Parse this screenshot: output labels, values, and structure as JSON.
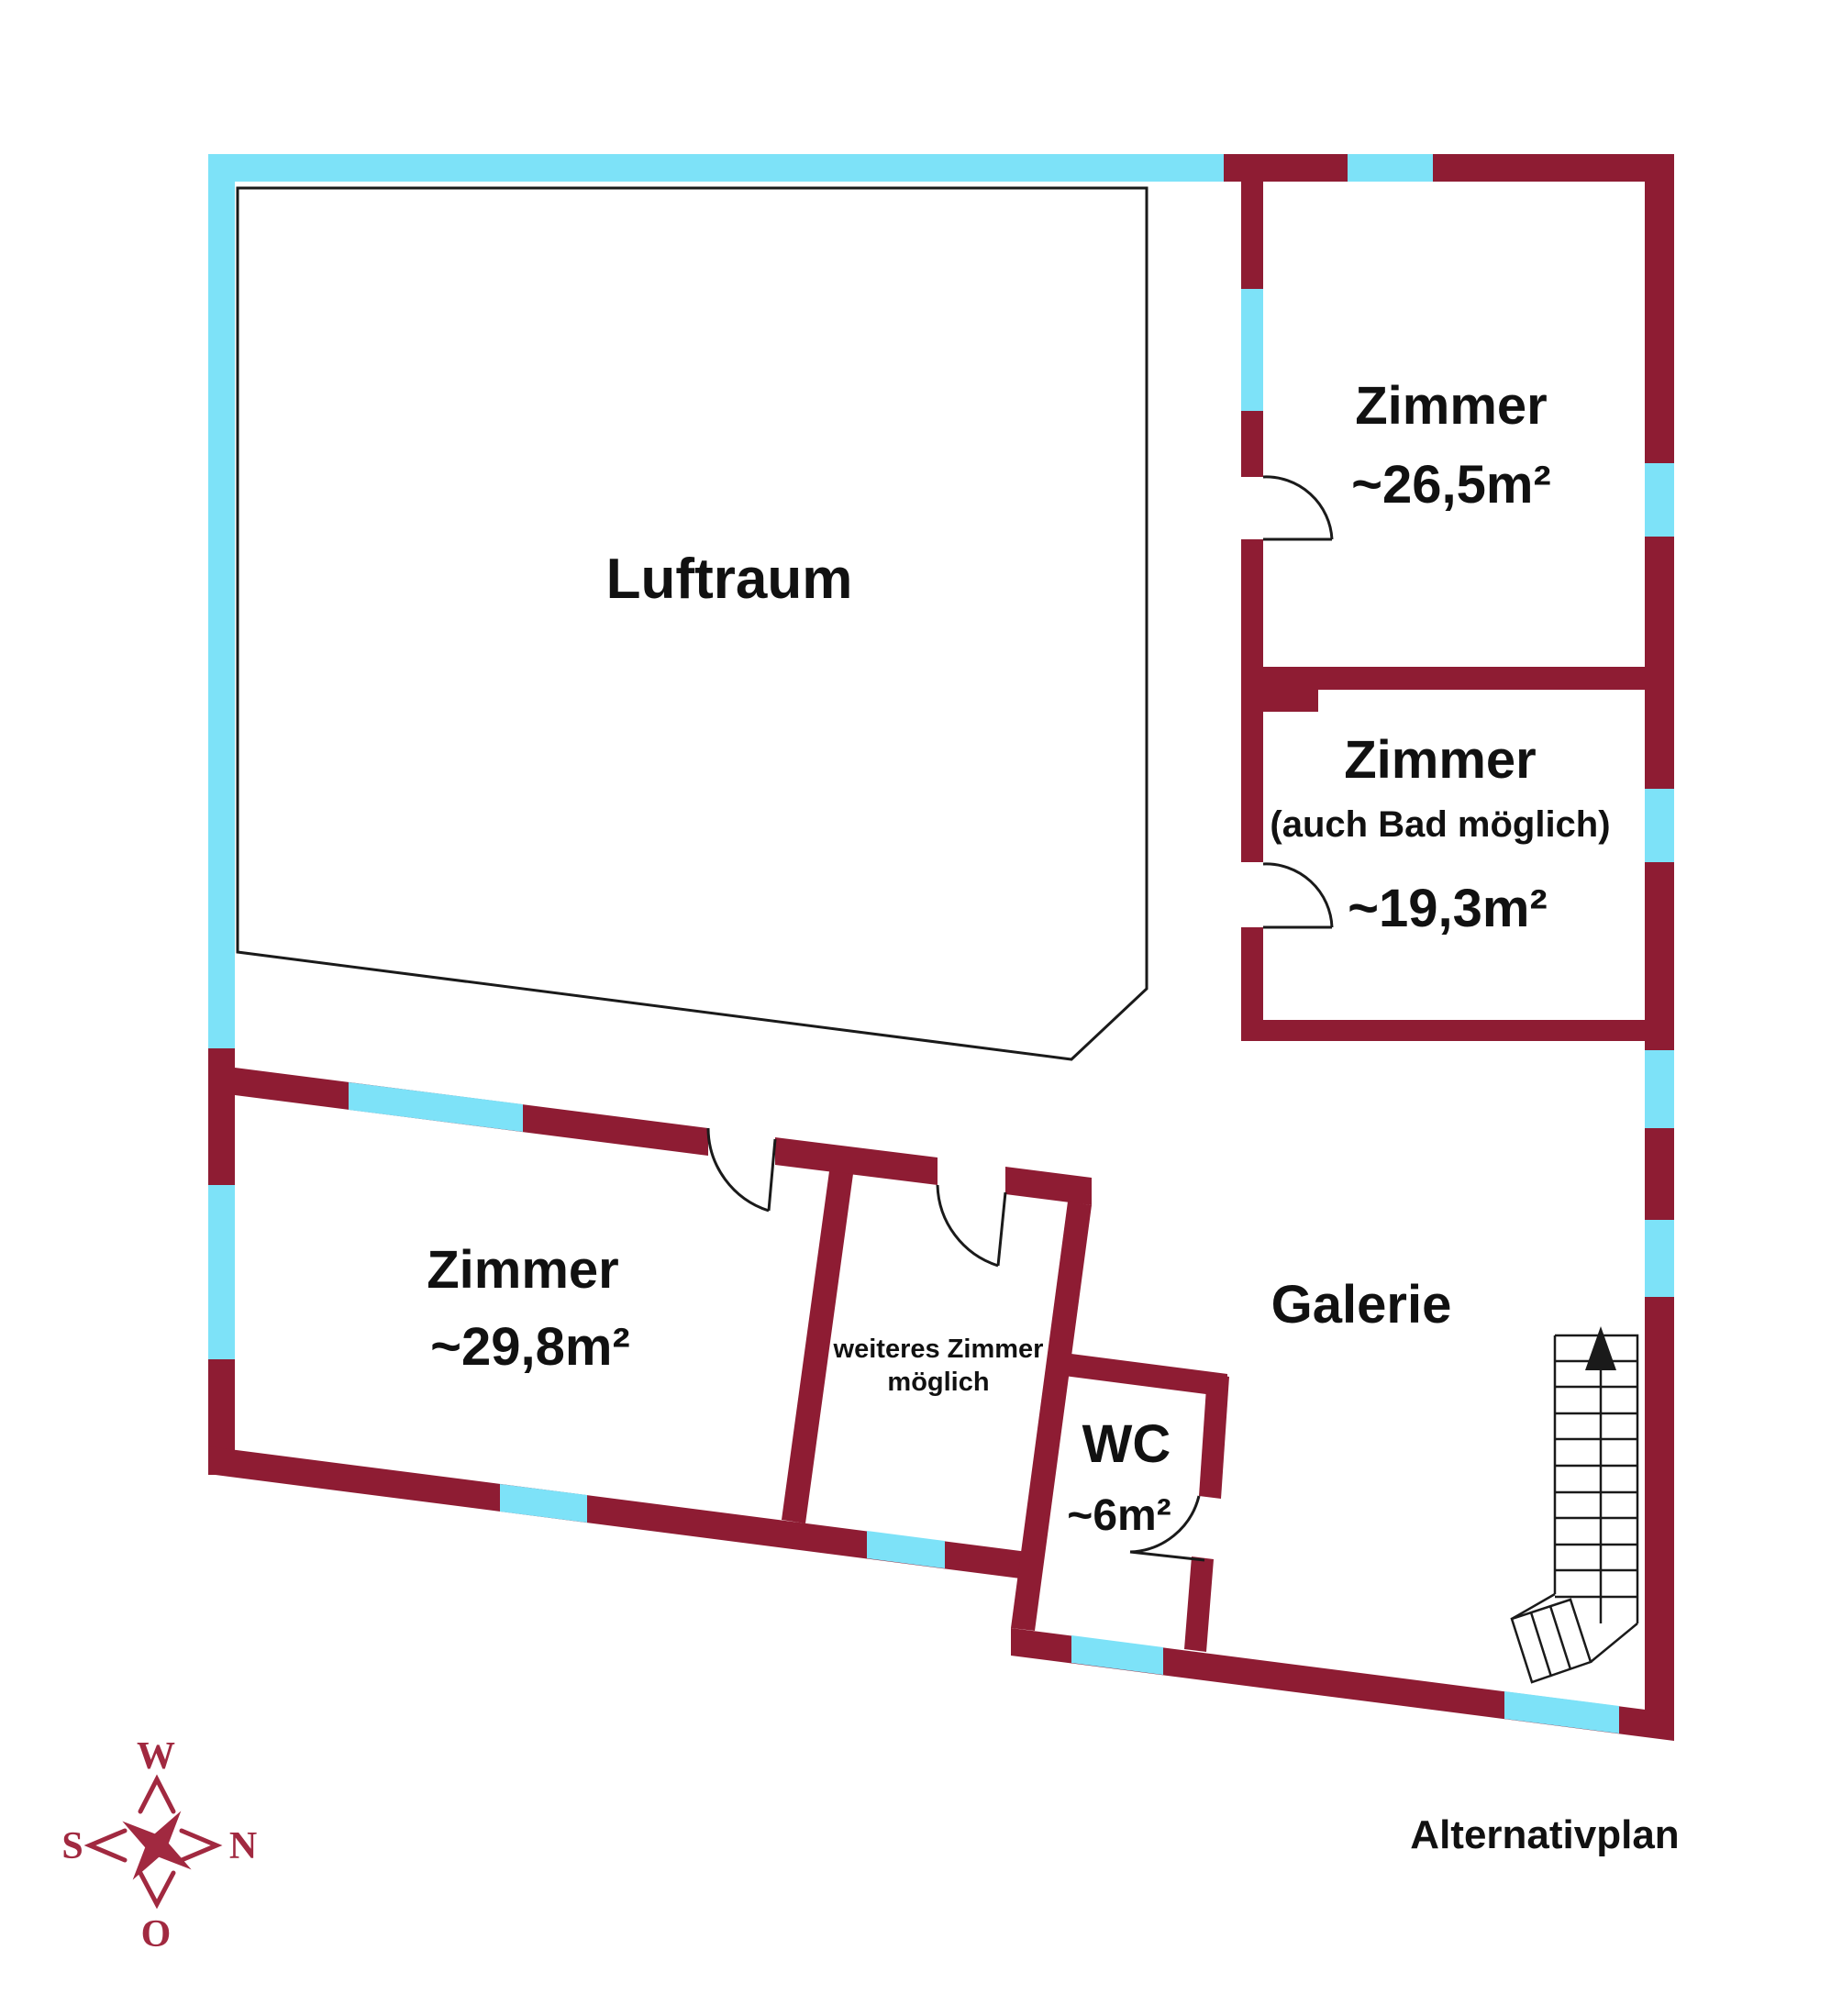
{
  "title": "Alternativplan",
  "colors": {
    "wall": "#8E1C33",
    "window": "#7DE2F8",
    "outline": "#1A1A1A",
    "compass": "#A12940",
    "text": "#111111",
    "background": "#FFFFFF"
  },
  "rooms": {
    "luftraum": {
      "label": "Luftraum"
    },
    "zimmer_26": {
      "label": "Zimmer",
      "area": "~26,5m²"
    },
    "zimmer_19": {
      "label": "Zimmer",
      "note": "(auch Bad möglich)",
      "area": "~19,3m²"
    },
    "zimmer_29": {
      "label": "Zimmer",
      "area": "~29,8m²"
    },
    "weiteres_zimmer": {
      "label_line1": "weiteres Zimmer",
      "label_line2": "möglich"
    },
    "wc": {
      "label": "WC",
      "area": "~6m²"
    },
    "galerie": {
      "label": "Galerie"
    }
  },
  "compass": {
    "top": "W",
    "left": "S",
    "right": "N",
    "bottom": "O"
  },
  "plan_label": "Alternativplan"
}
